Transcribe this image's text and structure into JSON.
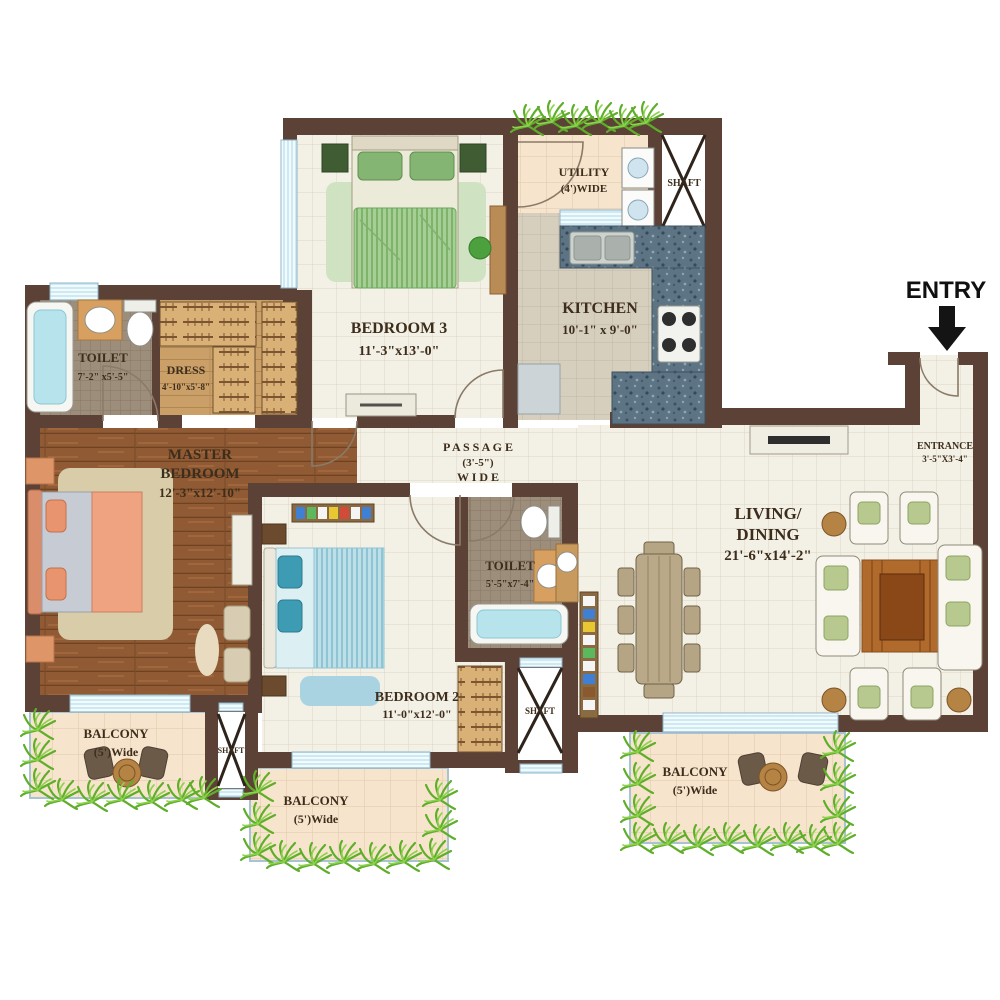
{
  "plan": {
    "entry_label": "ENTRY",
    "rooms": {
      "bedroom3": {
        "name": "BEDROOM 3",
        "dims": "11'-3\"x13'-0\""
      },
      "utility": {
        "name": "UTILITY",
        "dims": "(4')WIDE"
      },
      "shaft_top": {
        "name": "SHAFT"
      },
      "kitchen": {
        "name": "KITCHEN",
        "dims": "10'-1\" x 9'-0\""
      },
      "toilet1": {
        "name": "TOILET",
        "dims": "7'-2\" x5'-5\""
      },
      "dress": {
        "name": "DRESS",
        "dims": "4'-10\"x5'-8\""
      },
      "master": {
        "name_line1": "MASTER",
        "name_line2": "BEDROOM",
        "dims": "12'-3\"x12'-10\""
      },
      "passage": {
        "name": "P A S S A G E",
        "dims": "(3'-5\")",
        "wide": "W I D E"
      },
      "toilet2": {
        "name": "TOILET",
        "dims": "5'-5\"x7'-4\""
      },
      "bedroom2": {
        "name": "BEDROOM 2",
        "dims": "11'-0\"x12'-0\""
      },
      "living": {
        "name_line1": "LIVING/",
        "name_line2": "DINING",
        "dims": "21'-6\"x14'-2\""
      },
      "entrance": {
        "name": "ENTRANCE",
        "dims": "3'-5\"X3'-4\""
      },
      "shaft_mid": {
        "name": "SHAFT"
      },
      "shaft_left": {
        "name": "SHAFT"
      },
      "balcony_left": {
        "name": "BALCONY",
        "dims": "(5')Wide"
      },
      "balcony_mid": {
        "name": "BALCONY",
        "dims": "(5')Wide"
      },
      "balcony_right": {
        "name": "BALCONY",
        "dims": "(5')Wide"
      }
    },
    "colors": {
      "wall": "#5b4136",
      "wood_floor": "#8f5a34",
      "tile_floor": "#f3f0e5",
      "kitchen_counter": "#5d7484",
      "window": "#cdeaf4",
      "plant": "#5fae2a",
      "entry_arrow": "#141414"
    }
  }
}
